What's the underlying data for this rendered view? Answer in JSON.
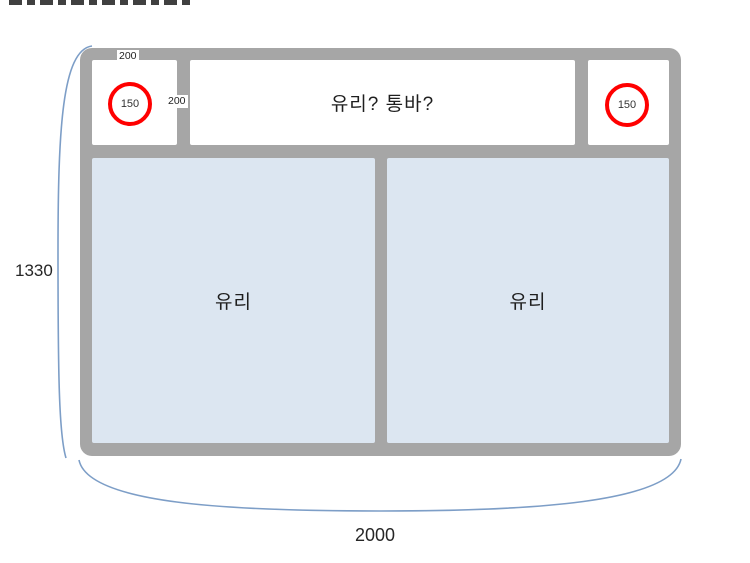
{
  "diagram": {
    "top_row": {
      "left_cell_circle_label": "150",
      "middle_section_label": "유리? 통바?",
      "right_cell_circle_label": "150"
    },
    "panels": {
      "left_label": "유리",
      "right_label": "유리"
    },
    "dimensions": {
      "top_cell_width": "200",
      "top_cell_height": "200",
      "overall_height": "1330",
      "overall_width": "2000"
    },
    "colors": {
      "frame_gray": "#a6a6a6",
      "glass_fill": "#dce6f1",
      "circle_red": "#ff0000",
      "dimension_blue": "#7d9ec7",
      "text": "#262626",
      "background": "#ffffff"
    }
  }
}
